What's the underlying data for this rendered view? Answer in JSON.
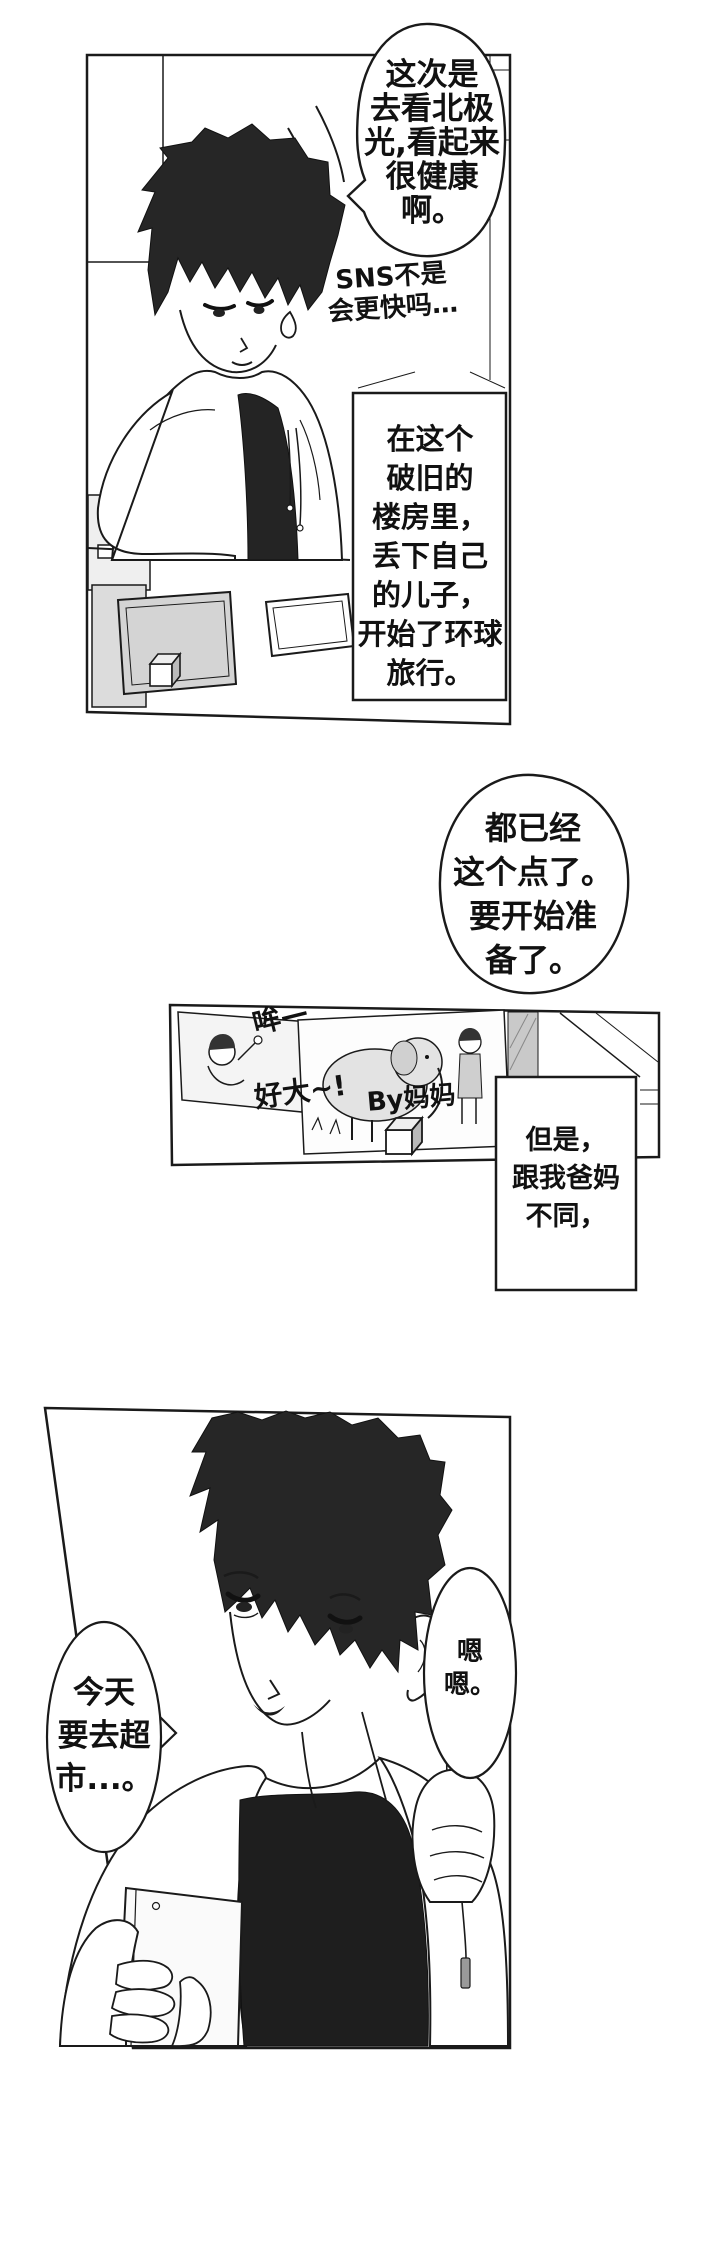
{
  "page": {
    "bg": "#ffffff",
    "ink": "#1a1a1a",
    "tone_gray": "#d4d4d4"
  },
  "panel1": {
    "speech_aurora": "这次是\n去看北极\n光,看起来\n很健康\n啊。",
    "thought_sns": "SNS不是\n会更快吗…",
    "narration_building": "在这个\n破旧的\n楼房里，\n丢下自己\n的儿子，\n开始了环球\n旅行。"
  },
  "gutter": {
    "speech_time": "都已经\n这个点了。\n要开始准\n备了。"
  },
  "panel2": {
    "sfx_moo": "哞—",
    "sfx_sobig": "好大~!",
    "sfx_bymom": "By妈妈",
    "narration_parents": "但是，\n跟我爸妈\n不同，"
  },
  "panel3": {
    "speech_supermarket": "今天\n要去超\n市...。",
    "speech_mmhmm": "嗯\n嗯。"
  }
}
